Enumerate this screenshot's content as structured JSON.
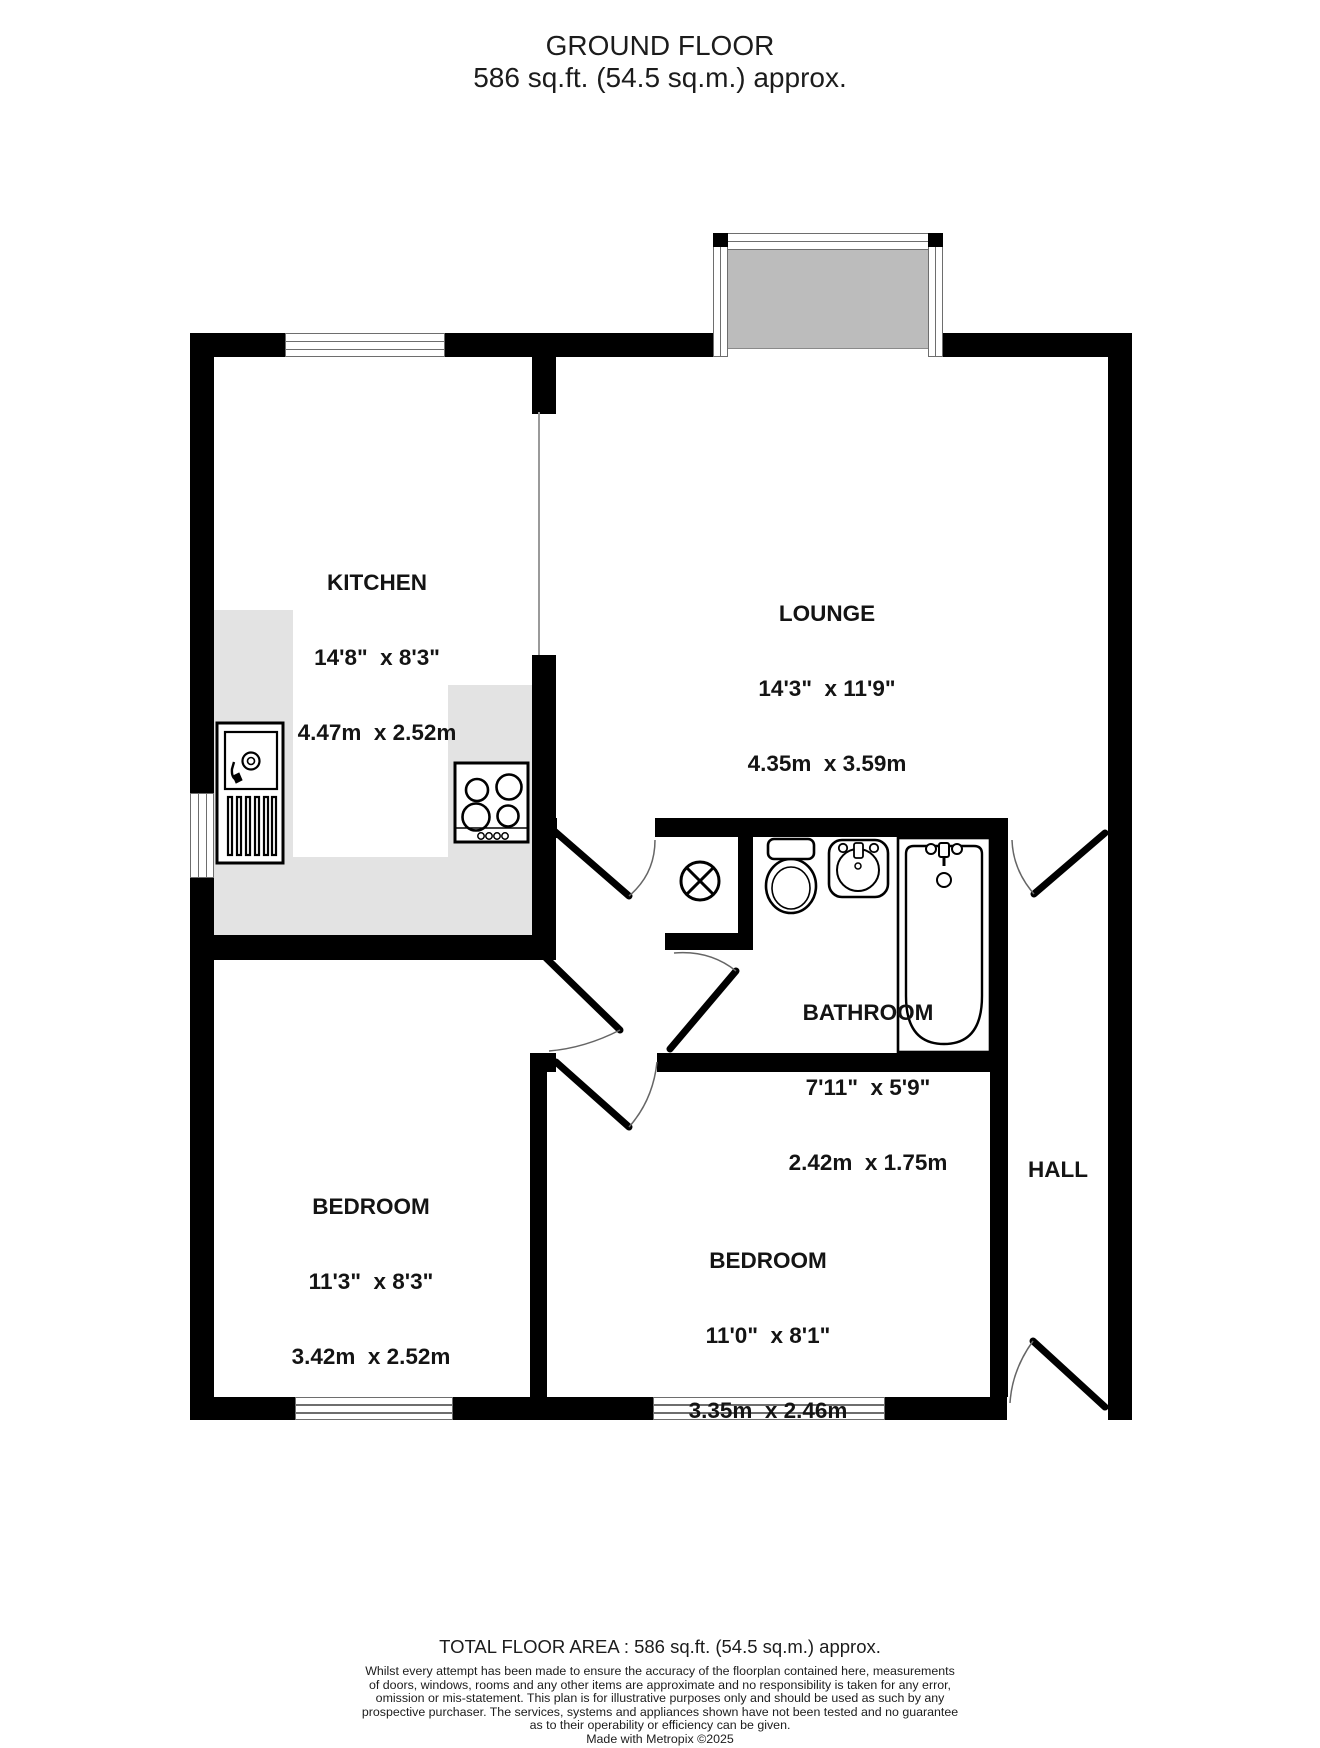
{
  "title": {
    "line1": "GROUND FLOOR",
    "line2": "586 sq.ft. (54.5 sq.m.) approx."
  },
  "rooms": {
    "kitchen": {
      "name": "KITCHEN",
      "imperial": "14'8\"  x 8'3\"",
      "metric": "4.47m  x 2.52m"
    },
    "lounge": {
      "name": "LOUNGE",
      "imperial": "14'3\"  x 11'9\"",
      "metric": "4.35m  x 3.59m"
    },
    "bathroom": {
      "name": "BATHROOM",
      "imperial": "7'11\"  x 5'9\"",
      "metric": "2.42m  x 1.75m"
    },
    "bedroom1": {
      "name": "BEDROOM",
      "imperial": "11'3\"  x 8'3\"",
      "metric": "3.42m  x 2.52m"
    },
    "bedroom2": {
      "name": "BEDROOM",
      "imperial": "11'0\"  x 8'1\"",
      "metric": "3.35m  x 2.46m"
    },
    "hall": {
      "name": "HALL"
    }
  },
  "fixtures": [
    "kitchen-sink-unit",
    "hob",
    "airing-cupboard",
    "toilet",
    "basin",
    "bath",
    "kitchen-window",
    "bedroom-window",
    "bedroom-window-2",
    "side-window",
    "patio-doors",
    "front-door"
  ],
  "footer": {
    "total_area": "TOTAL FLOOR AREA : 586 sq.ft. (54.5 sq.m.) approx.",
    "disclaimer_lines": [
      "Whilst every attempt has been made to ensure the accuracy of the floorplan contained here, measurements",
      "of doors, windows, rooms and any other items are approximate and no responsibility is taken for any error,",
      "omission or mis-statement. This plan is for illustrative purposes only and should be used as such by any",
      "prospective purchaser. The services, systems and appliances shown have not been tested and no guarantee",
      "as to their operability or efficiency can be given."
    ],
    "credit": "Made with Metropix ©2025"
  },
  "colors": {
    "wall": "#000000",
    "counter": "#e3e3e3",
    "patio_glass": "#bcbcbc",
    "text": "#141414"
  }
}
